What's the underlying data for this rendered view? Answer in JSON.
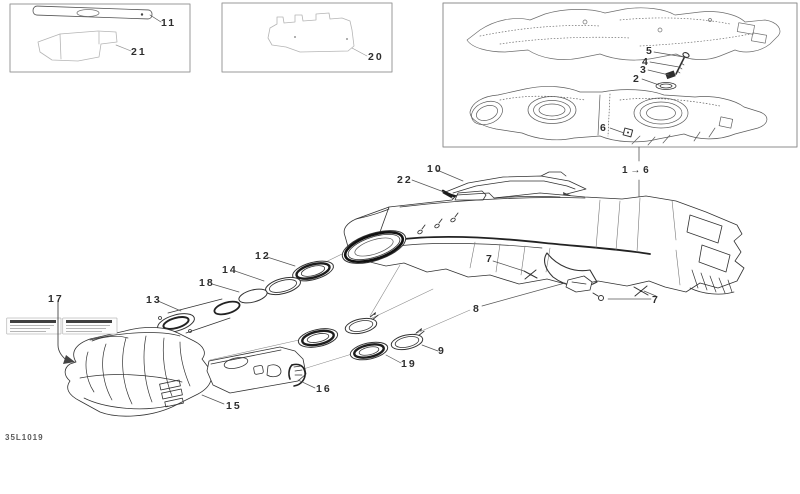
{
  "sheet": {
    "code": "35L1019"
  },
  "colors": {
    "line": "#333333",
    "dark_line": "#1a1a1a",
    "light_line": "#b5b5b5",
    "frame": "#999999",
    "label_text": "#2e2e2e"
  },
  "callouts": [
    {
      "part": "11",
      "label": "11"
    },
    {
      "part": "21",
      "label": "21"
    },
    {
      "part": "20",
      "label": "20"
    },
    {
      "part": "5",
      "label": "5"
    },
    {
      "part": "4",
      "label": "4"
    },
    {
      "part": "3",
      "label": "3"
    },
    {
      "part": "2",
      "label": "2"
    },
    {
      "part": "6",
      "label": "6"
    },
    {
      "part": "1-6",
      "label": "1 → 6"
    },
    {
      "part": "10",
      "label": "10"
    },
    {
      "part": "22",
      "label": "22"
    },
    {
      "part": "7a",
      "label": "7"
    },
    {
      "part": "8",
      "label": "8"
    },
    {
      "part": "7b",
      "label": "7"
    },
    {
      "part": "12",
      "label": "12"
    },
    {
      "part": "14",
      "label": "14"
    },
    {
      "part": "18",
      "label": "18"
    },
    {
      "part": "13",
      "label": "13"
    },
    {
      "part": "17",
      "label": "17"
    },
    {
      "part": "15",
      "label": "15"
    },
    {
      "part": "16",
      "label": "16"
    },
    {
      "part": "19",
      "label": "19"
    },
    {
      "part": "9",
      "label": "9"
    }
  ]
}
